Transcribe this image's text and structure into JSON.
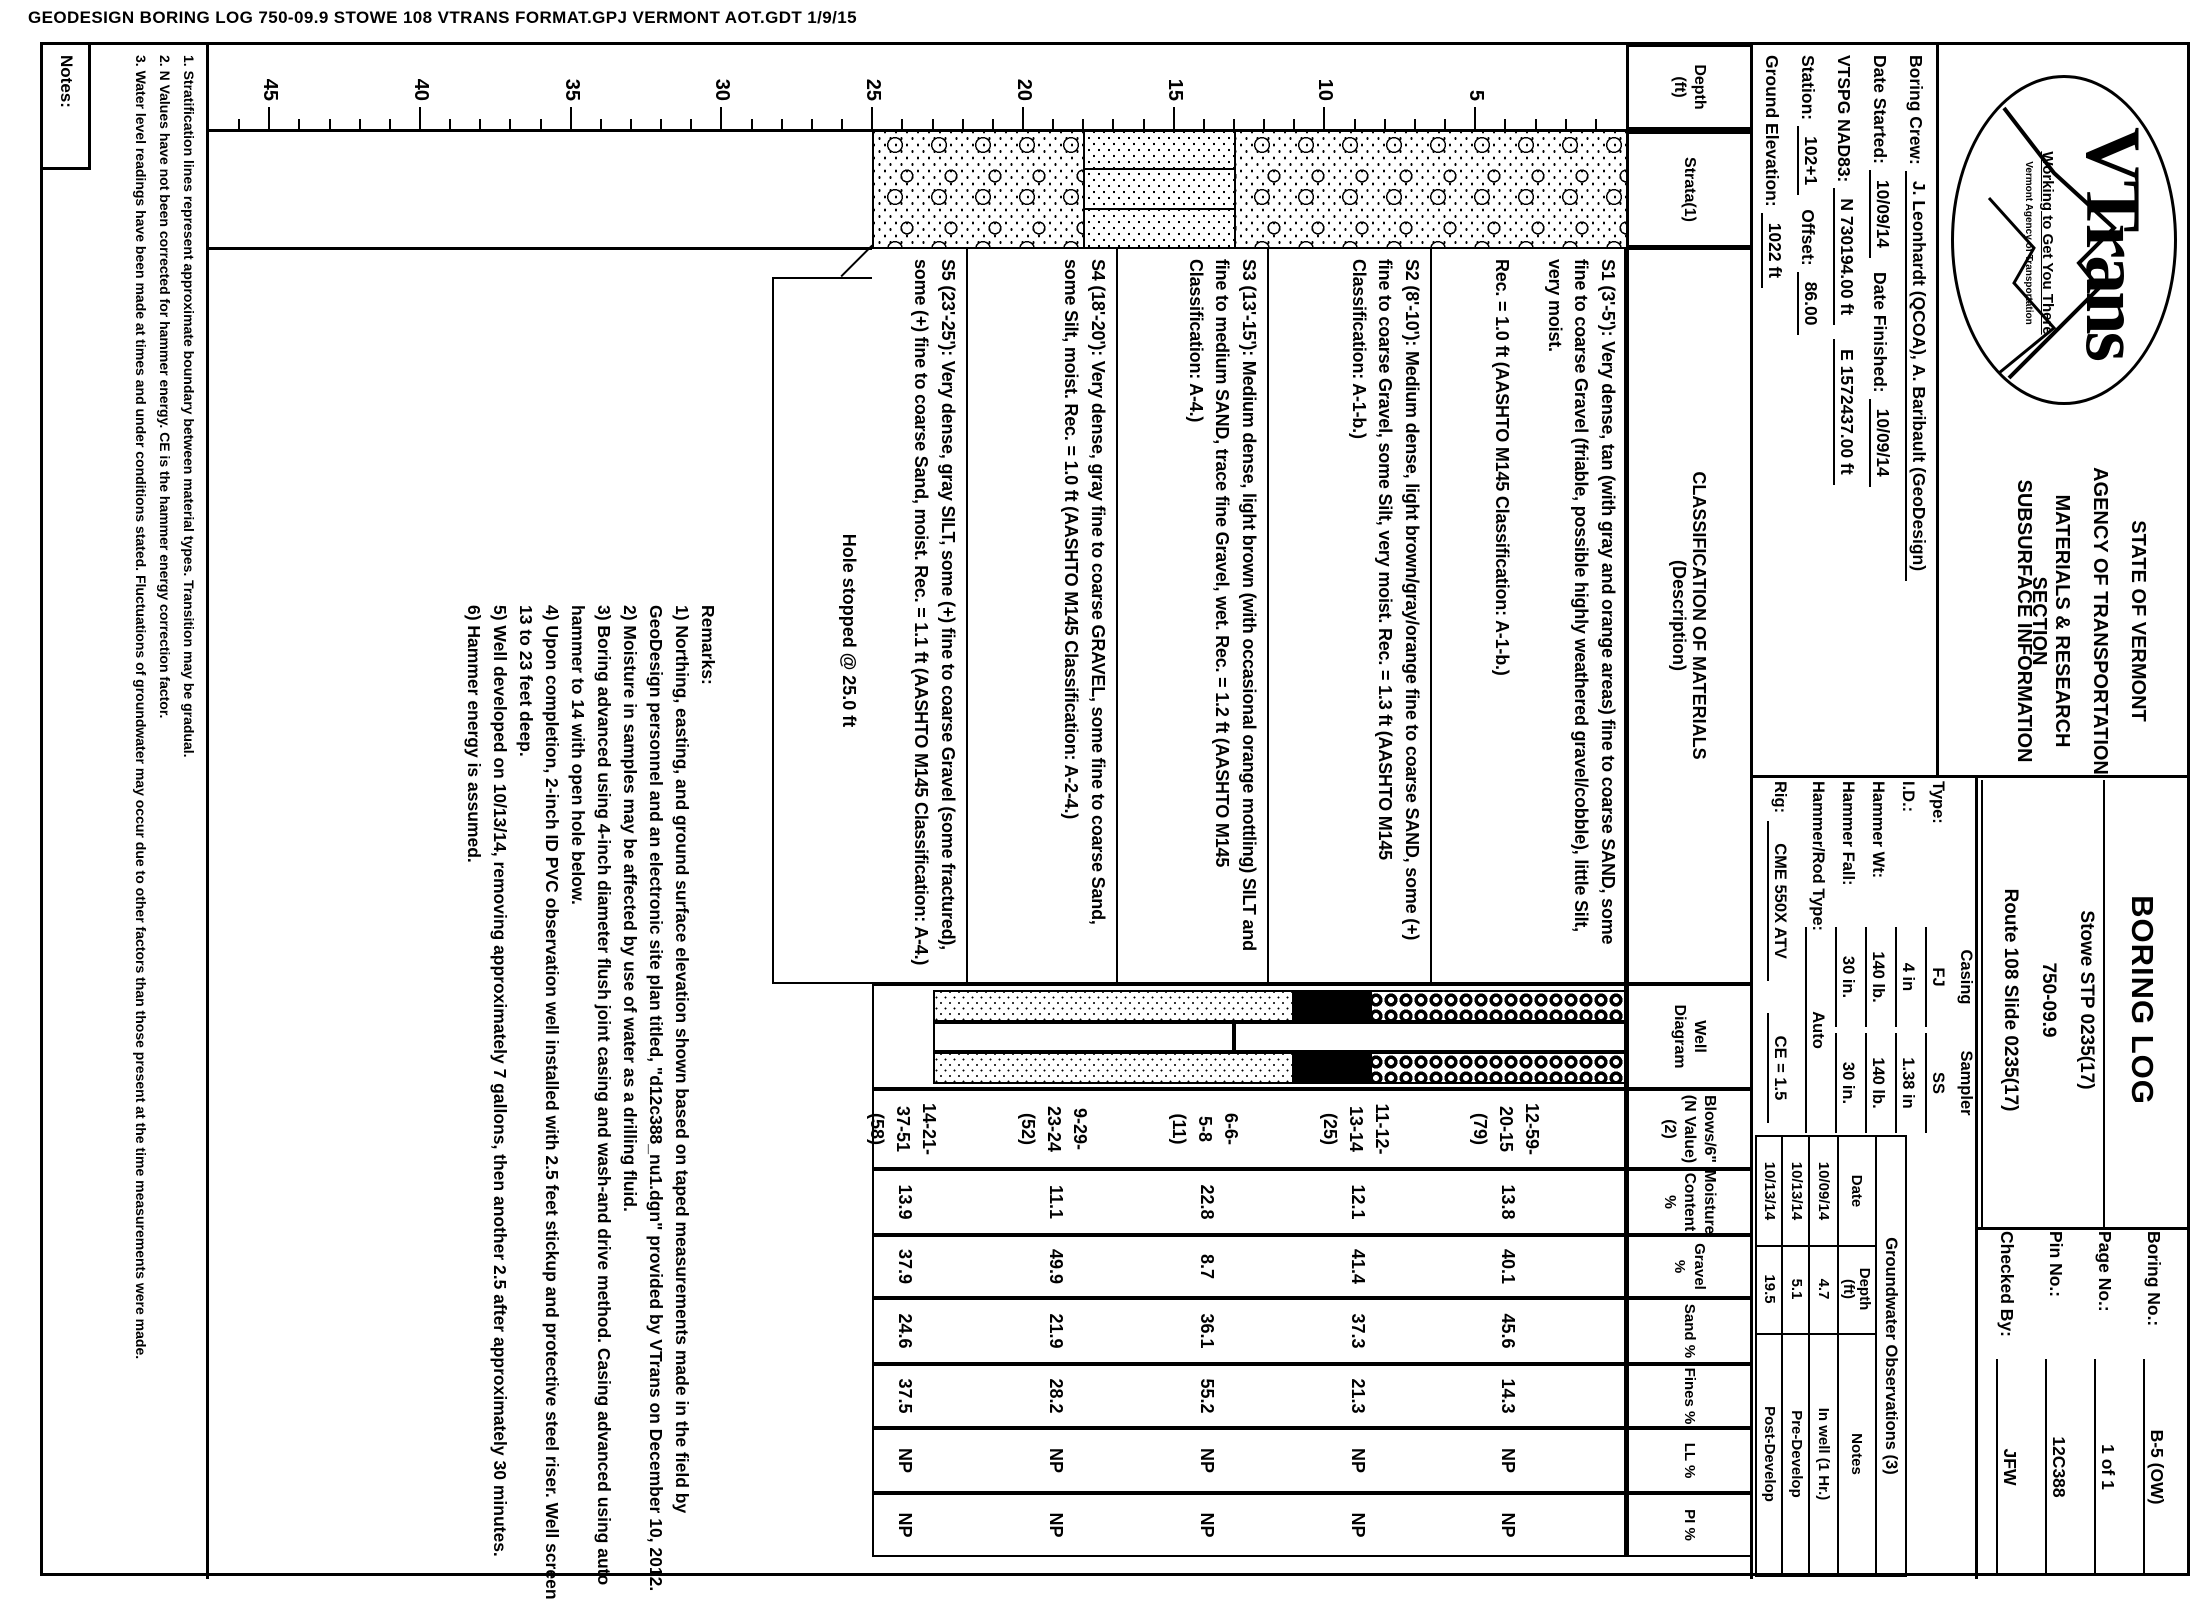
{
  "print_header": "GEODESIGN BORING LOG   750-09.9 STOWE 108 VTRANS FORMAT.GPJ   VERMONT AOT.GDT   1/9/15",
  "logo": {
    "brand": "VTrans",
    "tagline": "Working to Get You There",
    "org": "Vermont Agency of Transportation"
  },
  "agency_lines": [
    "STATE OF VERMONT",
    "AGENCY OF TRANSPORTATION",
    "MATERIALS & RESEARCH SECTION",
    "SUBSURFACE INFORMATION"
  ],
  "form": {
    "title": "BORING LOG",
    "project_lines": [
      "Stowe STP 0235(17)",
      "750-09.9",
      "Route 108 Slide 0235(17)"
    ],
    "fields": [
      {
        "label": "Boring No.:",
        "value": "B-5 (OW)"
      },
      {
        "label": "Page No.:",
        "value": "1 of 1"
      },
      {
        "label": "Pin No.:",
        "value": "12C388"
      },
      {
        "label": "Checked By:",
        "value": "JFW"
      }
    ]
  },
  "info_rows": [
    [
      {
        "l": "Boring Crew:",
        "v": "J. Leonhardt (QCOA), A. Baribault (GeoDesign)"
      }
    ],
    [
      {
        "l": "Date Started:",
        "v": "10/09/14"
      },
      {
        "l": "Date Finished:",
        "v": "10/09/14"
      }
    ],
    [
      {
        "l": "VTSPG NAD83:",
        "v": "N 730194.00 ft"
      },
      {
        "l": "",
        "v": "E 1572437.00 ft"
      }
    ],
    [
      {
        "l": "Station:",
        "v": "102+1"
      },
      {
        "l": "Offset:",
        "v": "86.00"
      }
    ],
    [
      {
        "l": "Ground Elevation:",
        "v": "1022 ft"
      }
    ]
  ],
  "equipment": {
    "col_a": "Casing",
    "col_b": "Sampler",
    "rows": [
      {
        "l": "Type:",
        "a": "FJ",
        "b": "SS"
      },
      {
        "l": "I.D.:",
        "a": "4 in",
        "b": "1.38 in"
      },
      {
        "l": "Hammer Wt:",
        "a": "140 lb.",
        "b": "140 lb."
      },
      {
        "l": "Hammer Fall:",
        "a": "30 in.",
        "b": "30 in."
      },
      {
        "l": "Hammer/Rod Type:",
        "a": "Auto",
        "b": ""
      }
    ],
    "rig_label": "Rig:",
    "rig": "CME 550X ATV",
    "ce": "CE = 1.5"
  },
  "groundwater": {
    "title": "Groundwater Observations (3)",
    "headers": [
      "Date",
      "Depth\n(ft)",
      "Notes"
    ],
    "rows": [
      [
        "10/09/14",
        "4.7",
        "In well (1 Hr.)"
      ],
      [
        "10/13/14",
        "5.1",
        "Pre-Develop"
      ],
      [
        "10/13/14",
        "19.5",
        "Post-Develop"
      ]
    ]
  },
  "table_headers": {
    "depth": "Depth\n(ft)",
    "strata": "Strata(1)",
    "classification": "CLASSIFICATION OF MATERIALS\n(Description)",
    "well": "Well\nDiagram",
    "blows": "Blows/6\"\n(N Value)(2)",
    "moisture": "Moisture\nContent %",
    "gravel": "Gravel %",
    "sand": "Sand %",
    "fines": "Fines %",
    "ll": "LL %",
    "pi": "PI %"
  },
  "depth_axis": {
    "majors": [
      5,
      10,
      15,
      20,
      25,
      30,
      35,
      40,
      45
    ],
    "max_tick": 46
  },
  "strata_layers": [
    {
      "from": 0,
      "to": 13,
      "pattern": "sand-gravel"
    },
    {
      "from": 13,
      "to": 18,
      "pattern": "layered-fine"
    },
    {
      "from": 18,
      "to": 25,
      "pattern": "sand-gravel"
    }
  ],
  "samples": [
    {
      "id": "S1",
      "from": 3,
      "to": 5,
      "desc": "S1 (3'-5'): Very dense, tan (with gray and orange areas) fine to coarse SAND, some fine to coarse Gravel (friable, possible highly weathered gravel/cobble), little Silt, very moist.",
      "rec": "Rec. = 1.0 ft (AASHTO M145 Classification: A-1-b.)",
      "blows": [
        "12-59-",
        "20-15",
        "(79)"
      ],
      "moisture": "13.8",
      "gravel": "40.1",
      "sand": "45.6",
      "fines": "14.3",
      "ll": "NP",
      "pi": "NP"
    },
    {
      "id": "S2",
      "from": 8,
      "to": 10,
      "desc": "S2 (8'-10'): Medium dense, light brown/gray/orange fine to coarse SAND, some (+) fine to coarse Gravel, some Silt, very moist.",
      "rec": "Rec. = 1.3 ft (AASHTO M145 Classification: A-1-b.)",
      "blows": [
        "11-12-",
        "13-14",
        "(25)"
      ],
      "moisture": "12.1",
      "gravel": "41.4",
      "sand": "37.3",
      "fines": "21.3",
      "ll": "NP",
      "pi": "NP"
    },
    {
      "id": "S3",
      "from": 13,
      "to": 15,
      "desc": "S3 (13'-15'): Medium dense, light brown (with occasional orange mottling) SILT and fine to medium SAND, trace fine Gravel, wet.",
      "rec": "Rec. = 1.2 ft (AASHTO M145 Classification: A-4.)",
      "blows": [
        "6-6-",
        "5-8",
        "(11)"
      ],
      "moisture": "22.8",
      "gravel": "8.7",
      "sand": "36.1",
      "fines": "55.2",
      "ll": "NP",
      "pi": "NP"
    },
    {
      "id": "S4",
      "from": 18,
      "to": 20,
      "desc": "S4 (18'-20'): Very dense, gray fine to coarse GRAVEL, some fine to coarse Sand, some Silt, moist.",
      "rec": "Rec. = 1.0 ft (AASHTO M145 Classification: A-2-4.)",
      "blows": [
        "9-29-",
        "23-24",
        "(52)"
      ],
      "moisture": "11.1",
      "gravel": "49.9",
      "sand": "21.9",
      "fines": "28.2",
      "ll": "NP",
      "pi": "NP"
    },
    {
      "id": "S5",
      "from": 23,
      "to": 25,
      "desc": "S5 (23'-25'): Very dense, gray SILT, some (+) fine to coarse Gravel (some fractured), some (+) fine to coarse Sand, moist.",
      "rec": "Rec. = 1.1 ft (AASHTO M145 Classification: A-4.)",
      "blows": [
        "14-21-",
        "37-51",
        "(58)"
      ],
      "moisture": "13.9",
      "gravel": "37.9",
      "sand": "24.6",
      "fines": "37.5",
      "ll": "NP",
      "pi": "NP"
    }
  ],
  "hole_note": "Hole stopped @ 25.0 ft",
  "well": {
    "annulus": [
      {
        "from": 0,
        "to": 8.5,
        "pattern": "chips"
      },
      {
        "from": 8.5,
        "to": 11,
        "pattern": "seal"
      },
      {
        "from": 11,
        "to": 23,
        "pattern": "sandpack"
      }
    ],
    "pipe": [
      {
        "from": 0,
        "to": 13,
        "pattern": "riser"
      },
      {
        "from": 13,
        "to": 23,
        "pattern": "screen"
      }
    ],
    "total_depth": 25
  },
  "notes": {
    "label": "Notes:",
    "items": [
      "1. Stratification lines represent approximate boundary between material types. Transition may be gradual.",
      "2. N Values have not been corrected for hammer energy. CE is the hammer energy correction factor.",
      "3. Water level readings have been made at times and under conditions stated. Fluctuations of groundwater may occur due to other factors than those present at the time measurements were made."
    ]
  },
  "remarks": {
    "label": "Remarks:",
    "items": [
      "1) Northing, easting, and ground surface elevation shown based on taped measurements made in the field by GeoDesign personnel and an electronic site plan titled, \"d12c388_nu1.dgn\" provided by VTrans on December 10, 2012.",
      "2) Moisture in samples may be affected by use of water as a drilling fluid.",
      "3) Boring advanced using 4-inch diameter flush joint casing and wash-and drive method.  Casing advanced using auto hammer to 14 with open hole below.",
      "4) Upon completion, 2-inch ID PVC observation well installed with 2.5 feet stickup and protective steel riser.  Well screen 13 to 23 feet deep.",
      "5) Well developed on 10/13/14, removing approximately 7 gallons, then another 2.5 after approximately 30 minutes.",
      "6) Hammer energy is assumed."
    ]
  }
}
